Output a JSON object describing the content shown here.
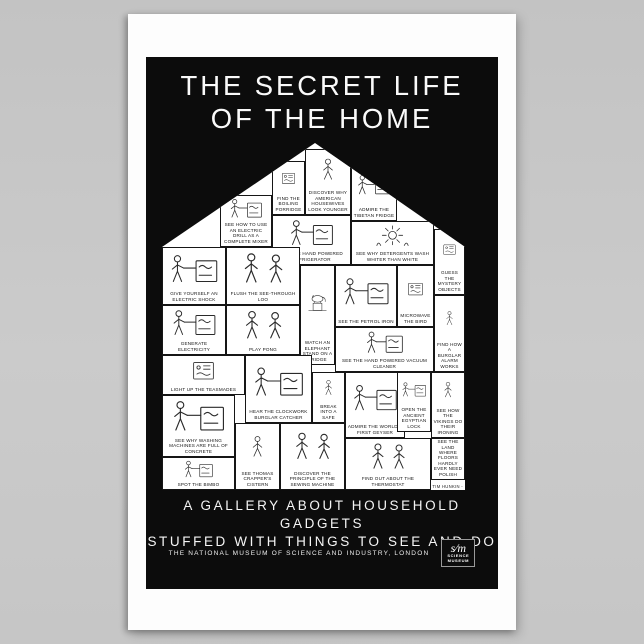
{
  "page": {
    "background": "#c7c7c7"
  },
  "poster": {
    "title_line1": "THE SECRET LIFE",
    "title_line2": "OF THE HOME",
    "tagline_line1": "A GALLERY ABOUT HOUSEHOLD GADGETS",
    "tagline_line2": "STUFFED WITH THINGS TO SEE AND DO",
    "museum_line": "THE NATIONAL MUSEUM OF SCIENCE AND INDUSTRY, LONDON",
    "signature": "- TIM HUNKIN -",
    "logo": {
      "monogram": "s∕m",
      "caption_line1": "SCIENCE",
      "caption_line2": "MUSEUM"
    },
    "colors": {
      "poster_paper": "#fdfdfd",
      "field": "#0c0c0c",
      "ink": "#161616",
      "backdrop": "#c7c7c7"
    }
  },
  "panels": [
    {
      "x": 110,
      "y": 18,
      "w": 33,
      "h": 54,
      "doodle": "machine",
      "caption": "FIND THE BOILING PORRIDGE"
    },
    {
      "x": 143,
      "y": 6,
      "w": 46,
      "h": 66,
      "doodle": "person",
      "caption": "DISCOVER WHY AMERICAN HOUSEWIVES LOOK YOUNGER"
    },
    {
      "x": 189,
      "y": 20,
      "w": 46,
      "h": 58,
      "doodle": "person-machine",
      "caption": "ADMIRE THE TIBETAN FRIDGE"
    },
    {
      "x": 58,
      "y": 52,
      "w": 52,
      "h": 52,
      "doodle": "person-machine",
      "caption": "SEE HOW TO USE AN ELECTRIC DRILL AS A COMPLETE MIXER"
    },
    {
      "x": 110,
      "y": 72,
      "w": 79,
      "h": 50,
      "doodle": "person-machine",
      "caption": "TRY THE HAND POWERED REFRIGERATOR"
    },
    {
      "x": 189,
      "y": 78,
      "w": 83,
      "h": 44,
      "doodle": "sun",
      "caption": "SEE WHY DETERGENTS WASH WHITER THAN WHITE"
    },
    {
      "x": 272,
      "y": 86,
      "w": 31,
      "h": 66,
      "doodle": "machine",
      "caption": "GUESS THE MYSTERY OBJECTS"
    },
    {
      "x": 0,
      "y": 104,
      "w": 64,
      "h": 58,
      "doodle": "person-machine",
      "caption": "GIVE YOURSELF AN ELECTRIC SHOCK"
    },
    {
      "x": 64,
      "y": 104,
      "w": 74,
      "h": 58,
      "doodle": "people",
      "caption": "FLUSH THE SEE-THROUGH LOO"
    },
    {
      "x": 138,
      "y": 122,
      "w": 35,
      "h": 100,
      "doodle": "elephant",
      "caption": "WATCH AN ELEPHANT STAND ON A FRIDGE"
    },
    {
      "x": 173,
      "y": 122,
      "w": 62,
      "h": 62,
      "doodle": "person-machine",
      "caption": "SEE THE PETROL IRON"
    },
    {
      "x": 235,
      "y": 122,
      "w": 37,
      "h": 62,
      "doodle": "machine",
      "caption": "MICROWAVE THE BIRD"
    },
    {
      "x": 272,
      "y": 152,
      "w": 31,
      "h": 77,
      "doodle": "person",
      "caption": "FIND HOW A BURGLAR ALARM WORKS"
    },
    {
      "x": 0,
      "y": 162,
      "w": 64,
      "h": 50,
      "doodle": "person-machine",
      "caption": "GENERATE ELECTRICITY"
    },
    {
      "x": 64,
      "y": 162,
      "w": 74,
      "h": 50,
      "doodle": "people",
      "caption": "PLAY PONG"
    },
    {
      "x": 173,
      "y": 184,
      "w": 99,
      "h": 45,
      "doodle": "person-machine",
      "caption": "SEE THE HAND POWERED VACUUM CLEANER"
    },
    {
      "x": 0,
      "y": 212,
      "w": 83,
      "h": 40,
      "doodle": "machine",
      "caption": "LIGHT UP THE TEASMADES"
    },
    {
      "x": 83,
      "y": 212,
      "w": 67,
      "h": 68,
      "doodle": "person-machine",
      "caption": "HEAR THE CLOCKWORK BURGLAR CATCHER"
    },
    {
      "x": 150,
      "y": 229,
      "w": 33,
      "h": 51,
      "doodle": "person",
      "caption": "BREAK INTO A SAFE"
    },
    {
      "x": 0,
      "y": 252,
      "w": 73,
      "h": 62,
      "doodle": "person-machine",
      "caption": "SEE WHY WASHING MACHINES ARE FULL OF CONCRETE"
    },
    {
      "x": 0,
      "y": 314,
      "w": 73,
      "h": 33,
      "doodle": "person-machine",
      "caption": "SPOT THE BIMBO"
    },
    {
      "x": 73,
      "y": 280,
      "w": 45,
      "h": 67,
      "doodle": "person",
      "caption": "SEE THOMAS CRAPPER'S CISTERN"
    },
    {
      "x": 118,
      "y": 280,
      "w": 65,
      "h": 67,
      "doodle": "people",
      "caption": "DISCOVER THE PRINCIPLE OF THE SEWING MACHINE"
    },
    {
      "x": 183,
      "y": 229,
      "w": 60,
      "h": 66,
      "doodle": "person-machine",
      "caption": "ADMIRE THE WORLD'S FIRST GEYSER"
    },
    {
      "x": 235,
      "y": 229,
      "w": 34,
      "h": 60,
      "doodle": "person-machine",
      "caption": "OPEN THE ANCIENT EGYPTIAN LOCK"
    },
    {
      "x": 269,
      "y": 229,
      "w": 34,
      "h": 66,
      "doodle": "person",
      "caption": "SEE HOW THE VIKINGS DO THEIR IRONING"
    },
    {
      "x": 183,
      "y": 295,
      "w": 86,
      "h": 52,
      "doodle": "people",
      "caption": "FIND OUT ABOUT THE THERMOSTAT"
    },
    {
      "x": 269,
      "y": 295,
      "w": 34,
      "h": 42,
      "doodle": "people",
      "caption": "SEE THE LAND WHERE FLOORS HARDLY EVER NEED POLISH"
    }
  ]
}
